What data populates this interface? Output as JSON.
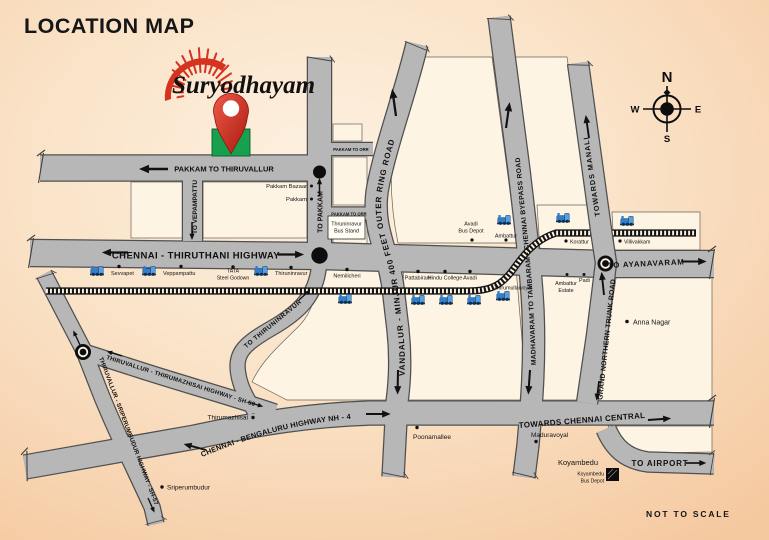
{
  "title": "LOCATION MAP",
  "logo": {
    "name": "Suryodhayam"
  },
  "scale_note": "NOT TO SCALE",
  "compass": {
    "n": "N",
    "e": "E",
    "s": "S",
    "w": "W"
  },
  "colors": {
    "background_peach": "#f8d7b4",
    "block_cream": "#fdf4e3",
    "road_gray": "#b7b7b7",
    "road_casing": "#4f4f4f",
    "accent_red": "#d5331f",
    "pin_green": "#17a14e",
    "train_blue": "#2e7fd0",
    "railway_black": "#141414"
  },
  "roads": {
    "pakkam_thiruvallur": "PAKKAM TO THIRUVALLUR",
    "to_vepampattu": "TO VEPAMPATTU",
    "to_pakkam": "TO PAKKAM",
    "pakkam_to_orr": "PAKKAM TO ORR",
    "chennai_thiruthani": "CHENNAI - THIRUTHANI HIGHWAY",
    "to_ayanavaram": "TO AYANAVARAM",
    "outer_ring": "VANDALUR - MINJUR 400 FEET OUTER RING ROAD",
    "byepass": "MADHAVARAM TO TAMBARAM - CHENNAI BYEPASS ROAD",
    "towards_manali": "TOWARDS MANALI",
    "grand_northern_trunk": "GRAND NORTHERN TRUNK ROAD",
    "nh4": "CHENNAI - BENGALURU HIGHWAY NH - 4",
    "chennai_central": "TOWARDS CHENNAI CENTRAL",
    "sh50": "THIRUVALLUR - THIRUMAZHISAI HIGHWAY - SH-50",
    "sh57": "THIRUVALLUR - SRIPERUMBUDUR HIGHWAY - SH-57",
    "to_thiruninravur": "TO THIRUNINRAVUR",
    "to_airport": "TO AIRPORT"
  },
  "stations": {
    "sevvapet": "Sevvapet",
    "veppampattu": "Veppampattu",
    "tata_l1": "TATA",
    "tata_l2": "Steel Godown",
    "thiruninravur": "Thiruninravur",
    "nemilicheri": "Nemilicheri",
    "pattabiram": "Pattabiram",
    "hindu_college": "Hindu College",
    "avadi": "Avadi",
    "thirumullaivoyal": "Thirumullaivoyal",
    "ambattur": "Ambattur",
    "korattur": "Korattur",
    "villivakkam": "Villivakkam"
  },
  "places": {
    "pakkam_bazaar": "Pakkam Bazaar",
    "pakkam": "Pakkam",
    "bus_stand_l1": "Thruninravur",
    "bus_stand_l2": "Bus Stand",
    "avadi_depot_l1": "Avadi",
    "avadi_depot_l2": "Bus Depot",
    "ambattur_estate_l1": "Ambattur",
    "ambattur_estate_l2": "Estate",
    "padi": "Padi",
    "anna_nagar": "Anna Nagar",
    "thirumazhisai": "Thirumazhisai",
    "poonamallee": "Poonamallee",
    "maduravoyal": "Maduravoyal",
    "koyambedu": "Koyambedu",
    "koyambedu_depot_l1": "Koyambedu",
    "koyambedu_depot_l2": "Bus Depot",
    "sriperumbudur": "Sriperumbudur"
  }
}
